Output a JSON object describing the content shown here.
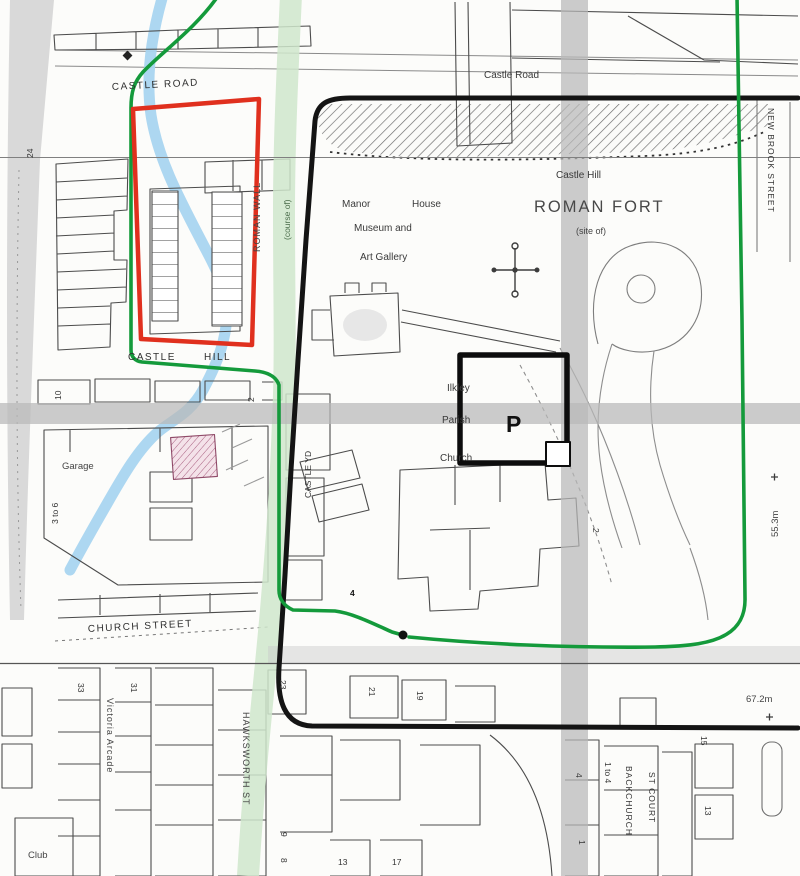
{
  "map": {
    "labels": {
      "castle_road_upper": "CASTLE ROAD",
      "castle_road": "Castle Road",
      "castle_hill": "Castle Hill",
      "roman_fort": "ROMAN FORT",
      "site_of": "(site of)",
      "manor": "Manor",
      "house": "House",
      "museum_and": "Museum and",
      "art_gallery": "Art Gallery",
      "roman_wall": "ROMAN WALL",
      "course_of": "(course of)",
      "castle": "CASTLE",
      "hill": "HILL",
      "ilkley": "Ilkley",
      "parish": "Parish",
      "church": "Church",
      "parking": "P",
      "garage": "Garage",
      "three_to_six": "3 to 6",
      "castle_yard": "CASTLE YD",
      "church_street": "CHURCH STREET",
      "victoria_arcade": "Victoria Arcade",
      "club": "Club",
      "hawksworth_st": "HAWKSWORTH ST",
      "backchurch": "BACKCHURCH",
      "st_court": "ST COURT",
      "one_to_four": "1 to 4",
      "new_brook_street": "NEW BROOK STREET",
      "spot_height_67": "67.2m",
      "spot_height_55": "55.3m"
    },
    "numbers": {
      "n24": "24",
      "n10": "10",
      "n2": "2",
      "n2b": "2",
      "n33": "33",
      "n31": "31",
      "n23": "23",
      "n21": "21",
      "n19": "19",
      "n9": "9",
      "n8": "8",
      "n13": "13",
      "n17": "17",
      "n15": "15",
      "n13b": "13",
      "n4": "4",
      "n4b": "4",
      "n1": "1"
    },
    "colors": {
      "boundary_green": "#149a3b",
      "boundary_red": "#e0301e",
      "boundary_black": "#141414",
      "stream_blue": "#a9d5f0",
      "roman_wall_strip": "#cfe6cb",
      "grid_band_gray": "#b9b9b9"
    },
    "symbols": {
      "antiquity_cross": "cross-of-antiquity",
      "boundary_point": "black-dot",
      "road_junction_point": "black-dot",
      "spot_plus": "plus-mark"
    }
  }
}
